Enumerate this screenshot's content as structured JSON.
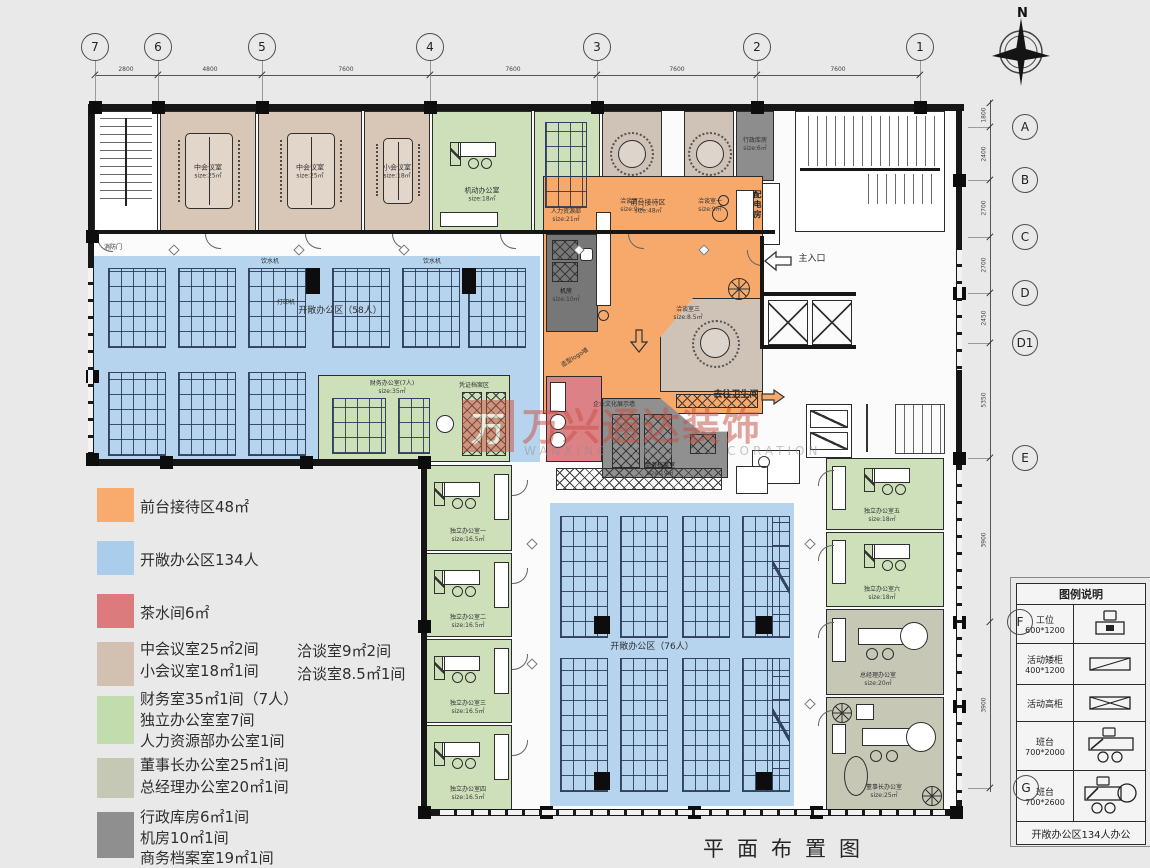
{
  "meta": {
    "title": "平面布置图",
    "compass_north": "N"
  },
  "grid": {
    "cols": [
      "7",
      "6",
      "5",
      "4",
      "3",
      "2",
      "1"
    ],
    "col_dims": [
      "2800",
      "4800",
      "7600",
      "7600",
      "7600",
      "7600"
    ],
    "rows": [
      "A",
      "B",
      "C",
      "D",
      "D1",
      "E",
      "F",
      "G"
    ],
    "row_dims": [
      "1800",
      "2400",
      "2700",
      "2700",
      "2450",
      "5350",
      "3900",
      "3900"
    ]
  },
  "colors": {
    "reception_orange": "#f6a96b",
    "open_office_blue": "#b7d4ee",
    "tea_room_red": "#dc8186",
    "meeting_tan": "#d8c7b7",
    "office_green": "#cde0ba",
    "exec_graygreen": "#c6c7b4",
    "service_gray": "#8d8d8d"
  },
  "watermark": {
    "logo_char": "万",
    "cn": "万兴通达装饰",
    "en": "WANXING TONGDA DECORATION"
  },
  "legend": {
    "items": [
      {
        "css": "background:#f8ab6d",
        "lines": [
          "前台接待区48㎡"
        ]
      },
      {
        "css": "background:#a9cdeb",
        "lines": [
          "开敞办公区134人"
        ]
      },
      {
        "css": "background:#dd7a7e",
        "lines": [
          "茶水间6㎡"
        ]
      },
      {
        "css": "background:#d2c0b1",
        "lines": [
          "中会议室25㎡2间",
          "小会议室18㎡1间"
        ],
        "col2": [
          "洽谈室9㎡2间",
          "洽谈室8.5㎡1间"
        ]
      },
      {
        "css": "background:#c2dcae",
        "lines": [
          "财务室35㎡1间（7人）",
          "独立办公室室7间",
          "人力资源部办公室1间"
        ]
      },
      {
        "css": "background:#c6c8b6",
        "lines": [
          "董事长办公室25㎡1间",
          "总经理办公室20㎡1间"
        ]
      },
      {
        "css": "background:#8f8f8f",
        "lines": [
          "行政库房6㎡1间",
          "机房10㎡1间",
          "商务档案室19㎡1间"
        ]
      }
    ]
  },
  "legend_table": {
    "title": "图例说明",
    "rows": [
      {
        "name": "工位",
        "size": "600*1200"
      },
      {
        "name": "活动矮柜",
        "size": "400*1200"
      },
      {
        "name": "活动高柜",
        "size": ""
      },
      {
        "name": "班台",
        "size": "700*2000"
      },
      {
        "name": "班台",
        "size": "700*2600"
      }
    ],
    "footer": "开敞办公区134人办公"
  },
  "rooms": {
    "meeting_mid_1": {
      "name": "中会议室",
      "size": "size:25㎡"
    },
    "meeting_mid_2": {
      "name": "中会议室",
      "size": "size:25㎡"
    },
    "meeting_small": {
      "name": "小会议室",
      "size": "size:18㎡"
    },
    "flex_office": {
      "name": "机动办公室",
      "size": "size:18㎡"
    },
    "hr": {
      "name": "人力资源部",
      "size": "size:21㎡"
    },
    "talk2": {
      "name": "洽谈室二",
      "size": "size:9㎡"
    },
    "talk1": {
      "name": "洽谈室一",
      "size": "size:9㎡"
    },
    "storage": {
      "name": "行政库房",
      "size": "size:6㎡"
    },
    "power": {
      "name": "配电房"
    },
    "reception": {
      "name": "前台接待区",
      "size": "size:48㎡"
    },
    "entrance": {
      "name": "主入口"
    },
    "server": {
      "name": "机房",
      "size": "size:10㎡"
    },
    "talk3": {
      "name": "洽谈室三",
      "size": "size:8.5㎡"
    },
    "archive": {
      "name": "商务档案室",
      "size": "size:19㎡"
    },
    "to_wc": {
      "name": "去往卫生间"
    },
    "open58": {
      "name": "开敞办公区（58人）"
    },
    "finance": {
      "name": "财务办公室(7人)",
      "size": "size:35㎡"
    },
    "voucher": {
      "name": "凭证档案区"
    },
    "open76": {
      "name": "开敞办公区（76人）"
    },
    "office1": {
      "name": "独立办公室一",
      "size": "size:16.5㎡"
    },
    "office2": {
      "name": "独立办公室二",
      "size": "size:16.5㎡"
    },
    "office3": {
      "name": "独立办公室三",
      "size": "size:16.5㎡"
    },
    "office4": {
      "name": "独立办公室四",
      "size": "size:16.5㎡"
    },
    "office5": {
      "name": "独立办公室五",
      "size": "size:18㎡"
    },
    "office6": {
      "name": "独立办公室六",
      "size": "size:18㎡"
    },
    "gm": {
      "name": "总经理办公室",
      "size": "size:20㎡"
    },
    "chairman": {
      "name": "董事长办公室",
      "size": "size:25㎡"
    },
    "fire_door": {
      "name": "消防门"
    },
    "logo_wall": {
      "name": "造型logo墙"
    },
    "culture_wall": {
      "name": "企业文化展示墙"
    },
    "water": {
      "name": "饮水机"
    },
    "printer": {
      "name": "打印机"
    }
  }
}
